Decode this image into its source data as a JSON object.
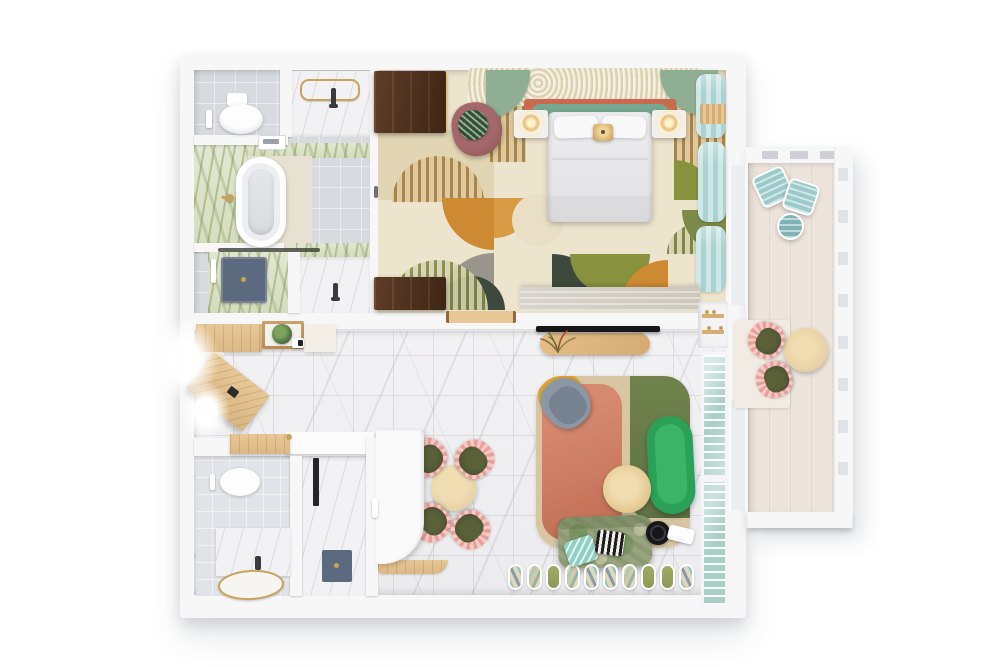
{
  "scene": {
    "view": "top-down 3d render",
    "subject": "one-bedroom suite floor plan with side balcony",
    "background": "#ffffff"
  },
  "rooms": [
    {
      "name": "main-bathroom",
      "furniture": [
        "wall-hung-toilet",
        "top-vanity-with-gold-towel-rail",
        "freestanding-oval-bathtub",
        "walk-in-shower-with-dark-mat",
        "second-vanity",
        "green-onyx-marble-floor-panels"
      ]
    },
    {
      "name": "bedroom",
      "furniture": [
        "double-bed-white-duvet",
        "two-pillows",
        "teal-headboard",
        "terracotta-headboard-shelf",
        "shag-rug-nook",
        "sage-partition-wings",
        "nightstand-left-with-lamp",
        "nightstand-right-with-lamp",
        "rattan-pendant-lamp",
        "walnut-wardrobe",
        "walnut-console",
        "mauve-armchair",
        "leaf-print-cushion",
        "geometric-patchwork-rug",
        "light-blue-curtains",
        "travertine-bench",
        "wood-door-threshold"
      ]
    },
    {
      "name": "entry-corridor",
      "furniture": [
        "oak-cabinet",
        "open-shelf-unit",
        "potted-plant",
        "kettle-tray",
        "white-cabinet",
        "angled-oak-desk",
        "marble-tile-floor",
        "window-light-glow"
      ]
    },
    {
      "name": "living-dining-room",
      "furniture": [
        "wall-mounted-tv",
        "oval-media-console",
        "dried-flower-arrangement",
        "round-dining-table",
        "four-olive-chairs-with-pink-sherpa-trim",
        "layered-area-rug-beige-pink-green",
        "mustard-accent-circle",
        "gray-lounge-chair",
        "green-capsule-sofa",
        "round-coffee-table",
        "distressed-green-loveseat",
        "mint-pillow",
        "zigzag-pillow",
        "robot-vacuum-with-dock",
        "window-bench-cushion-row",
        "kitchenette-counter",
        "teal-louvered-shutters",
        "wall-niche-with-bottles"
      ]
    },
    {
      "name": "second-bathroom",
      "furniture": [
        "wall-hung-toilet",
        "marble-vanity",
        "gold-rimmed-basin",
        "shower-column",
        "dark-shower-mat",
        "wood-counter-segment"
      ]
    },
    {
      "name": "balcony",
      "furniture": [
        "two-teal-bistro-chairs",
        "teal-bistro-table",
        "round-wood-table",
        "two-olive-chairs-with-pink-trim",
        "slatted-railing",
        "plank-floor",
        "door-mat"
      ]
    }
  ],
  "bench_slats": [
    "patterned",
    "tan",
    "olive",
    "tan",
    "patterned",
    "patterned",
    "tan",
    "olive",
    "olive",
    "patterned"
  ],
  "dining_chairs_count": 4,
  "palette": {
    "wall": "#f7f7f8",
    "floorTile": "#d7dade",
    "tileLight": "#e0e3e7",
    "greenMarbleA": "#e3e7d2",
    "greenMarbleB": "#d4dcbd",
    "beigeFloor": "#e7e1d2",
    "marble": "#f2f1f3",
    "marbleDark": "#ececef",
    "woodLight": "#e6c795",
    "woodMid": "#d3ad74",
    "walnut": "#5f3d28",
    "walnutDark": "#3f2514",
    "rugCream": "#ece4cd",
    "rugTanLight": "#e2d5b4",
    "rugStripeBg": "#dec9a0",
    "rugStripe": "#a98448",
    "rugOrange": "#cd8a32",
    "rugOrangeLight": "#d89a44",
    "rugOlive": "#87913e",
    "rugOliveStripe": "#7d8a3c",
    "rugDarkGreen": "#3d4a3b",
    "rugGray": "#9a958a",
    "rugGreen": "#7d8a4a",
    "shag": "#e9dfc4",
    "sage": "#8fae93",
    "salmon": "#c96a4e",
    "headboard": "#78a892",
    "bedWhite": "#ededef",
    "pillowWhite": "#f8f8f9",
    "mauve": "#a4676a",
    "mauveDark": "#8a5154",
    "leaf": "#2f5132",
    "leafDark": "#3f5c35",
    "curtain": "#cfe7e6",
    "curtainDark": "#a9d2d0",
    "travertine": "#cdc8bc",
    "tv": "#17171a",
    "livRugBeige": "#d8c6a2",
    "livRugPink": "#d68a70",
    "livRugPinkDeep": "#bf6c52",
    "livRugGreen": "#70834c",
    "livRugGreenDeep": "#5e7246",
    "mustard": "#d9a437",
    "grayChair": "#8b97a5",
    "grayChairDark": "#76828f",
    "sofa": "#2aa156",
    "sofaLight": "#3cb468",
    "loveA": "#9aa37f",
    "loveB": "#8c9a72",
    "mint": "#8fd0c2",
    "zigDark": "#1d1d1f",
    "zigLight": "#f2efe9",
    "chairOlive": "#4c5231",
    "chairPink": "#e89f9a",
    "chairPinkLight": "#f7c9c4",
    "balcFloor": "#ede4dc",
    "balcTeal": "#9ccaca",
    "balcTealDark": "#7fb3b5",
    "gold": "#c9a25e",
    "glass": "#e8eff0",
    "shutter": "#a8cfc6",
    "mat": "#5b6a7e"
  }
}
